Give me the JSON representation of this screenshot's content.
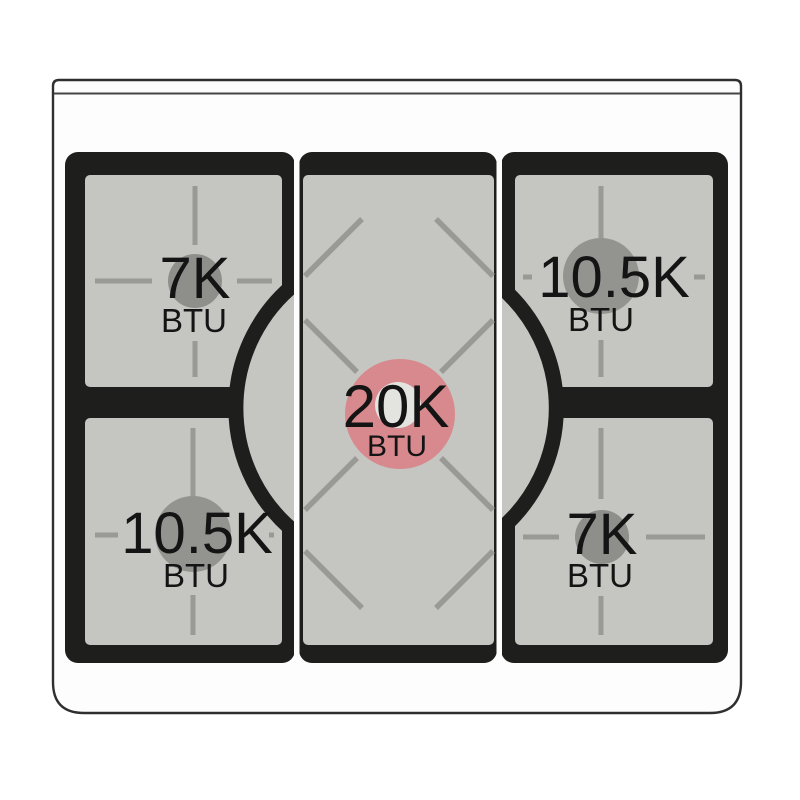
{
  "diagram": {
    "kind": "gas-cooktop-burner-layout",
    "burners": [
      {
        "position": "rear-left",
        "power": "7K",
        "unit": "BTU",
        "size": "small",
        "highlighted": false
      },
      {
        "position": "rear-right",
        "power": "10.5K",
        "unit": "BTU",
        "size": "medium",
        "highlighted": false
      },
      {
        "position": "center",
        "power": "20K",
        "unit": "BTU",
        "size": "large",
        "highlighted": true
      },
      {
        "position": "front-left",
        "power": "10.5K",
        "unit": "BTU",
        "size": "medium",
        "highlighted": false
      },
      {
        "position": "front-right",
        "power": "7K",
        "unit": "BTU",
        "size": "small",
        "highlighted": false
      }
    ],
    "colors": {
      "highlight_burner": "#d8898e",
      "highlight_burner_inner": "#e3e4e0",
      "burner_cap_small": "#8e8f8b",
      "burner_cap_medium": "#939490",
      "grate_black": "#1e1e1c",
      "surface_gray": "#c5c6c2",
      "grate_line_gray": "#999a96",
      "body_white": "#fdfdfd",
      "body_border": "#2f2f2f"
    }
  }
}
